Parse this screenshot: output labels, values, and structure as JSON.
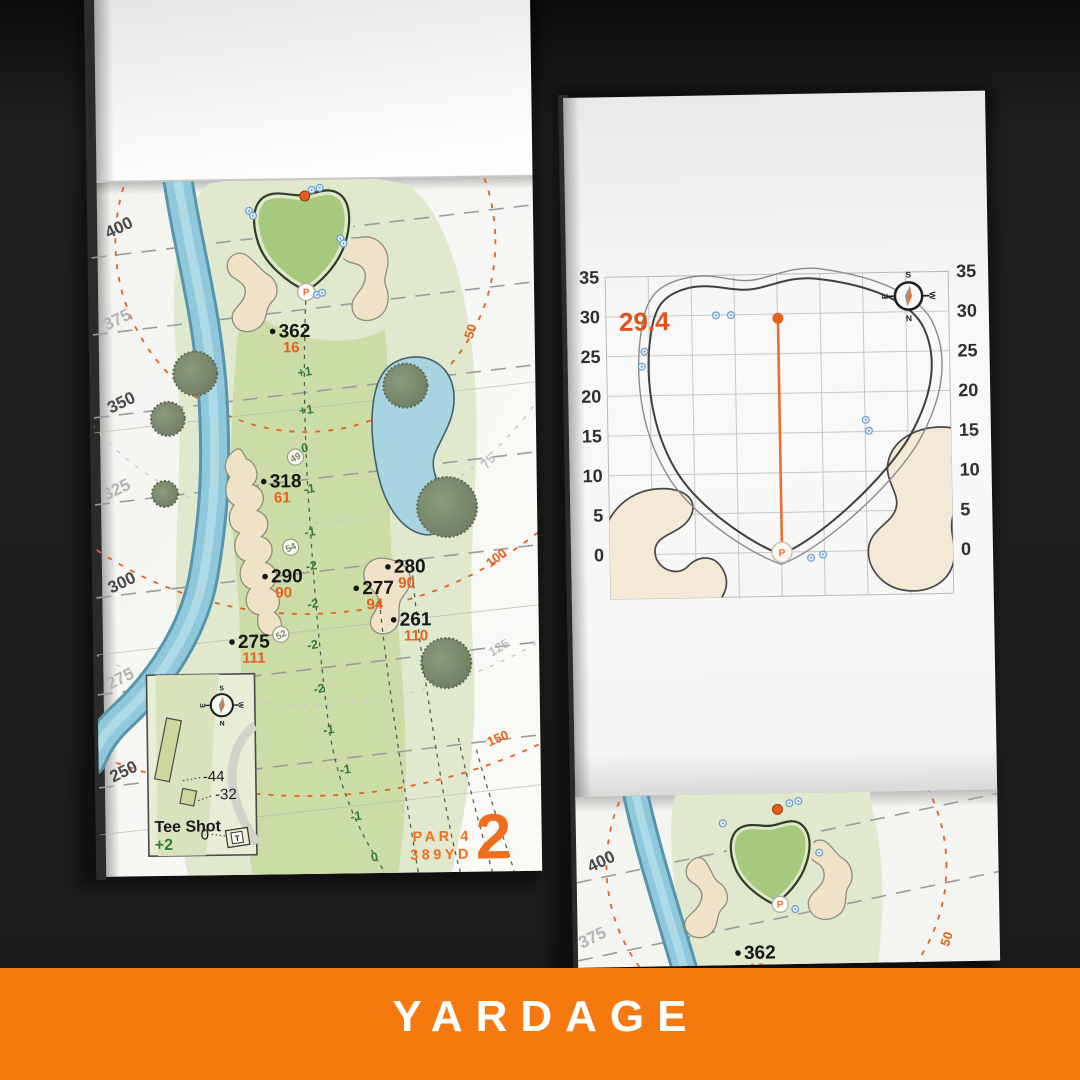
{
  "banner": {
    "label": "YARDAGE",
    "bg_color": "#F5790F",
    "text_color": "#FFFFFF"
  },
  "book": {
    "hole": {
      "number": "2",
      "par": "PAR 4",
      "yardage": "389YD",
      "tee_yardage_lines": [
        {
          "label": "400",
          "tone": "dark"
        },
        {
          "label": "375",
          "tone": "light"
        },
        {
          "label": "350",
          "tone": "dark"
        },
        {
          "label": "325",
          "tone": "light"
        },
        {
          "label": "300",
          "tone": "dark"
        },
        {
          "label": "275",
          "tone": "light"
        },
        {
          "label": "250",
          "tone": "dark"
        }
      ],
      "distance_rings": [
        {
          "label": "50",
          "color": "orange"
        },
        {
          "label": "75",
          "color": "gray"
        },
        {
          "label": "100",
          "color": "orange"
        },
        {
          "label": "125",
          "color": "gray"
        },
        {
          "label": "150",
          "color": "orange"
        }
      ],
      "carry_points": [
        {
          "distance": "362",
          "to_pin": "16"
        },
        {
          "distance": "318",
          "to_pin": "61"
        },
        {
          "distance": "290",
          "to_pin": "90"
        },
        {
          "distance": "280",
          "to_pin": "90"
        },
        {
          "distance": "277",
          "to_pin": "94"
        },
        {
          "distance": "261",
          "to_pin": "110"
        },
        {
          "distance": "275",
          "to_pin": "111"
        }
      ],
      "elevation_marks": [
        "+1",
        "+1",
        "0",
        "-1",
        "-1",
        "-2",
        "-2",
        "-2",
        "-2",
        "-1",
        "-1",
        "-1",
        "0"
      ],
      "node_markers": [
        "49",
        "54",
        "52"
      ],
      "pin_symbol": "P"
    },
    "inset": {
      "title": "Tee Shot",
      "tee_shot_value": "+2",
      "back_tee_offset": "-44",
      "mid_tee_offset": "-32",
      "front_tee_offset": "0",
      "tee_marker": "T"
    },
    "compass": {
      "north": "N",
      "south": "S",
      "east": "E",
      "west": "W"
    },
    "green_chart": {
      "depth_value": "29.4",
      "axis_ticks_left": [
        "35",
        "30",
        "25",
        "20",
        "15",
        "10",
        "5",
        "0"
      ],
      "axis_ticks_right": [
        "35",
        "30",
        "25",
        "20",
        "15",
        "10",
        "5",
        "0"
      ]
    },
    "next_page": {
      "yardage_lines": [
        {
          "label": "400",
          "tone": "dark"
        },
        {
          "label": "375",
          "tone": "light"
        }
      ],
      "carry_point": {
        "distance": "362",
        "to_pin": "16"
      },
      "ring_label": "50"
    }
  },
  "colors": {
    "accent_orange": "#E8611C",
    "print_orange": "#EE6E1E",
    "green_text": "#2E7D32",
    "ink": "#1A1A1A"
  }
}
